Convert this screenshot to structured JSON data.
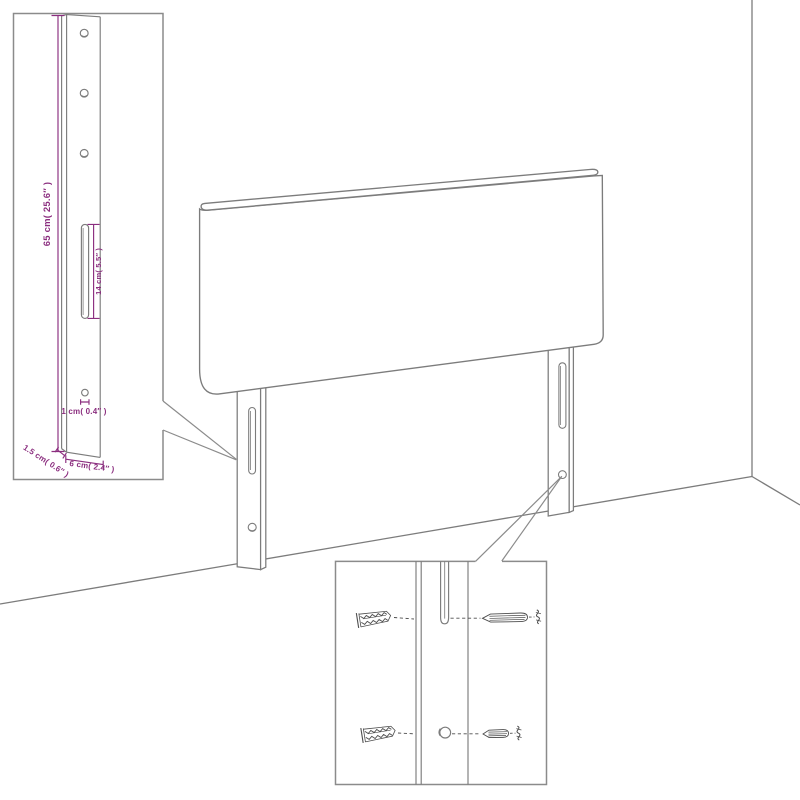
{
  "page": {
    "background": "#ffffff",
    "description": "Line-art dimension diagram of a wall-mounted headboard with two mounting legs, one leg-dimension callout inset and one wall-fixing hardware callout inset"
  },
  "colors": {
    "outline": "#7c7c7c",
    "box_border": "#8b8b8b",
    "dimension": "#8b2e7f",
    "hardware": "#4d4d4d",
    "background": "#ffffff"
  },
  "leg_detail_inset": {
    "labels": {
      "height": "65 cm( 25.6″ )",
      "slot_length": "14 cm( 5.5″ )",
      "hole_diameter": "1 cm( 0.4″ )",
      "depth": "1.5 cm( 0.6″ )",
      "width": "6 cm( 2.4″ )"
    },
    "screw_hole_count": 3
  },
  "mounting_detail_inset": {
    "rows": [
      {
        "left": "wall-plug-icon",
        "center": "mounting-slot",
        "right": "screw-icon"
      },
      {
        "left": "wall-plug-icon",
        "center": "round-hole",
        "right": "screw-icon"
      }
    ]
  }
}
